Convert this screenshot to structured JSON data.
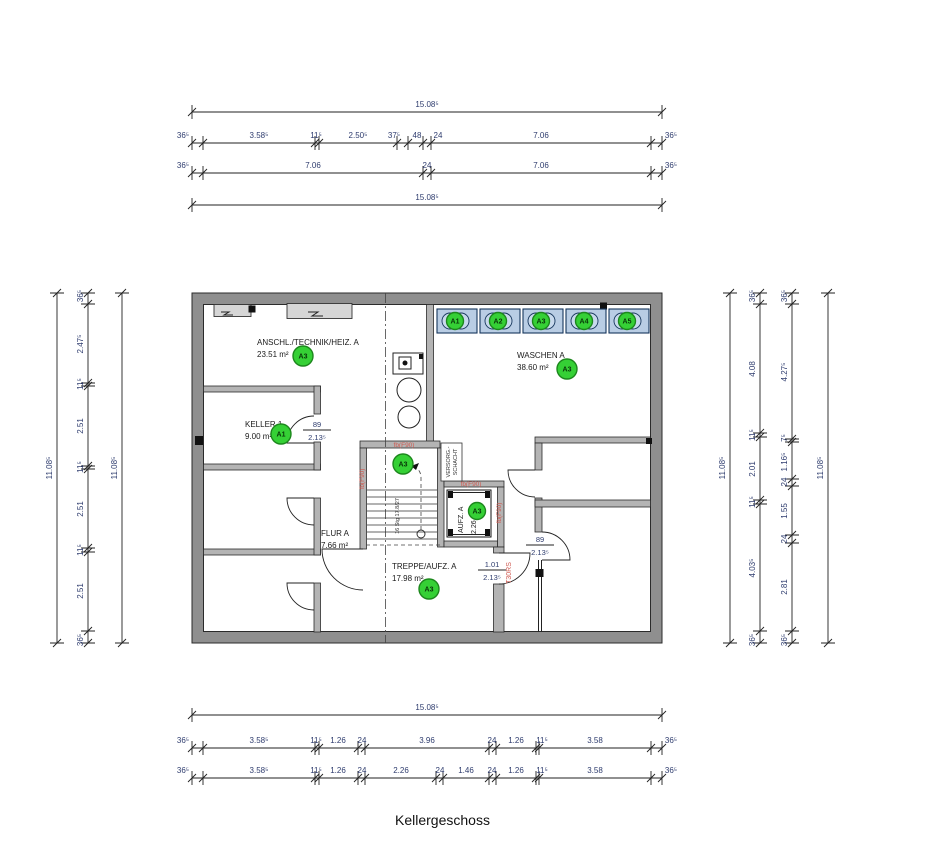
{
  "title": "Kellergeschoss",
  "colors": {
    "wall": "#8f8f8f",
    "inner_wall": "#b4b4b4",
    "dim_text": "#2e3c6e",
    "fire_red": "#cf5b52",
    "tag_green": "#35d035",
    "machine_blue": "#b9cde4"
  },
  "dims": {
    "w_total": "15.08⁵",
    "h_total": "11.08⁵",
    "t2": [
      "36⁵",
      "3.58⁵",
      "11⁵",
      "2.50⁵",
      "37⁵",
      "48",
      "24",
      "7.06",
      "36⁵"
    ],
    "t3": [
      "36⁵",
      "7.06",
      "24",
      "7.06",
      "36⁵"
    ],
    "b2": [
      "36⁵",
      "3.58⁵",
      "11⁵",
      "1.26",
      "24",
      "3.96",
      "24",
      "1.26",
      "11⁵",
      "3.58",
      "36⁵"
    ],
    "b3": [
      "36⁵",
      "3.58⁵",
      "11⁵",
      "1.26",
      "24",
      "2.26",
      "24",
      "1.46",
      "24",
      "1.26",
      "11⁵",
      "3.58",
      "36⁵"
    ],
    "l2": [
      "36⁵",
      "2.47⁵",
      "11⁵",
      "2.51",
      "11⁵",
      "2.51",
      "11⁵",
      "2.51",
      "36⁵"
    ],
    "r2": [
      "36⁵",
      "4.08",
      "11⁵",
      "2.01",
      "11⁵",
      "4.03⁵",
      "36⁵"
    ],
    "r3": [
      "36⁵",
      "4.27⁵",
      "7⁵",
      "1.16⁵",
      "24",
      "1.55",
      "24",
      "2.81",
      "36⁵"
    ]
  },
  "rooms": {
    "anschl": {
      "name": "ANSCHL./TECHNIK/HEIZ. A",
      "area": "23.51 m²",
      "tag": "A3"
    },
    "waschen": {
      "name": "WASCHEN A",
      "area": "38.60 m²",
      "tag": "A3"
    },
    "keller": {
      "name": "KELLER 1",
      "area": "9.00 m²",
      "tag": "A1"
    },
    "flur": {
      "name": "FLUR A",
      "area": "7.66 m²"
    },
    "treppe": {
      "name": "TREPPE/AUFZ. A",
      "area": "17.98 m²",
      "tag": "A3"
    },
    "aufzug": {
      "name": "AUFZ. A",
      "area": "2.26 m²",
      "tag": "A3"
    }
  },
  "doors": {
    "keller": {
      "w": "89",
      "h": "2.13⁵"
    },
    "right": {
      "w": "89",
      "h": "2.13⁵"
    },
    "t30": {
      "w": "1.01",
      "h": "2.13⁵"
    }
  },
  "stair": {
    "note": "16 Stg 17.8/27",
    "tag": "A3"
  },
  "shaft": {
    "line1": "VERSORG.-",
    "line2": "SCHACHT"
  },
  "fire": {
    "f90": "fb(F90)",
    "t30": "T30RS"
  },
  "machines": [
    "A1",
    "A2",
    "A3",
    "A4",
    "A5"
  ]
}
